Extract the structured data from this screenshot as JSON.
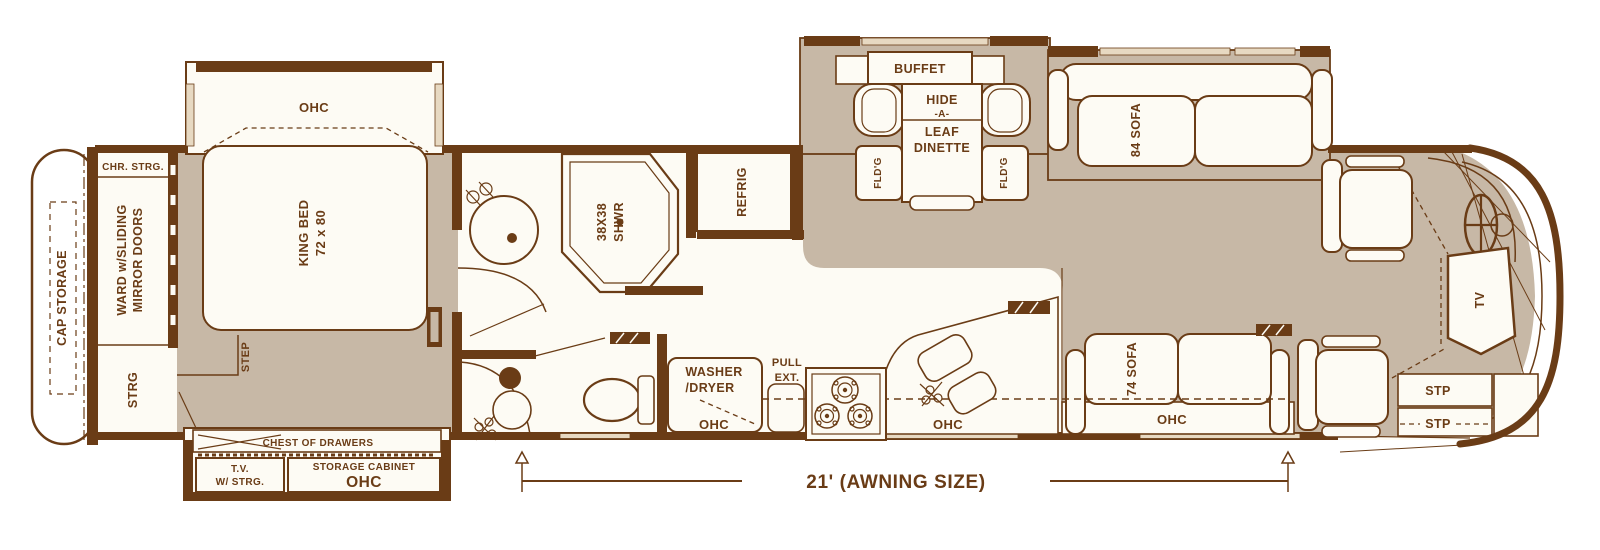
{
  "colors": {
    "wall_brown": "#6a3c16",
    "carpet_tan": "#c7b8a6",
    "floor_white": "#fdfbf4",
    "window_tan": "#e7d9c2"
  },
  "labels": {
    "cap_storage": "CAP STORAGE",
    "chr_strg": "CHR. STRG.",
    "ward_line1": "WARD w/SLIDING",
    "ward_line2": "MIRROR DOORS",
    "strg": "STRG",
    "bedroom_ohc": "OHC",
    "king_bed_line1": "KING BED",
    "king_bed_line2": "72 x 80",
    "step": "STEP",
    "chest_of_drawers": "CHEST OF DRAWERS",
    "tv_strg_line1": "T.V.",
    "tv_strg_line2": "W/ STRG.",
    "storage_cabinet": "STORAGE CABINET",
    "storage_cabinet_ohc": "OHC",
    "shower_line1": "38X38",
    "shower_line2": "SHWR",
    "refrig": "REFRIG",
    "washer_line1": "WASHER",
    "washer_line2": "/DRYER",
    "washer_ohc": "OHC",
    "pull_line1": "PULL",
    "pull_line2": "EXT.",
    "kitchen_ohc": "OHC",
    "buffet": "BUFFET",
    "dinette_line1": "HIDE",
    "dinette_line2": "-A-",
    "dinette_line3": "LEAF",
    "dinette_line4": "DINETTE",
    "fldg_left": "FLD'G",
    "fldg_right": "FLD'G",
    "sofa_84": "84 SOFA",
    "sofa_74": "74 SOFA",
    "sofa_ohc": "OHC",
    "tv_front": "TV",
    "stp_upper": "STP",
    "stp_lower": "STP",
    "awning": "21' (AWNING SIZE)"
  }
}
